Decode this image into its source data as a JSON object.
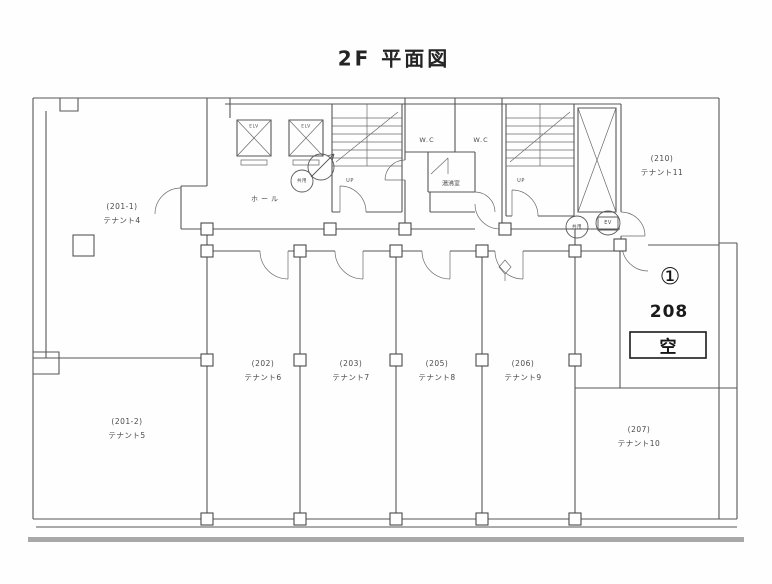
{
  "title": "2F 平面図",
  "rooms": [
    {
      "number": "(201-1)",
      "tenant": "テナント4"
    },
    {
      "number": "(201-2)",
      "tenant": "テナント5"
    },
    {
      "number": "(202)",
      "tenant": "テナント6"
    },
    {
      "number": "(203)",
      "tenant": "テナント7"
    },
    {
      "number": "(205)",
      "tenant": "テナント8"
    },
    {
      "number": "(206)",
      "tenant": "テナント9"
    },
    {
      "number": "(207)",
      "tenant": "テナント10"
    },
    {
      "number": "(210)",
      "tenant": "テナント11"
    }
  ],
  "vacant_room": {
    "marker": "①",
    "number": "208",
    "status": "空"
  },
  "facilities": {
    "hall": "ホール",
    "wc_left": "W.C",
    "wc_right": "W.C",
    "kitchenette": "湯沸室",
    "elevator_left": "ELV",
    "elevator_right": "ELV",
    "stair_left_up": "UP",
    "stair_right_up": "UP",
    "shared_stamp_left": "共用",
    "shared_stamp_right": "共用",
    "elevator_stamp": "EV"
  },
  "colors": {
    "line": "#565656",
    "label": "#4a4a4a",
    "highlight_text": "#161616",
    "page_edge": "#a8a8a8"
  }
}
